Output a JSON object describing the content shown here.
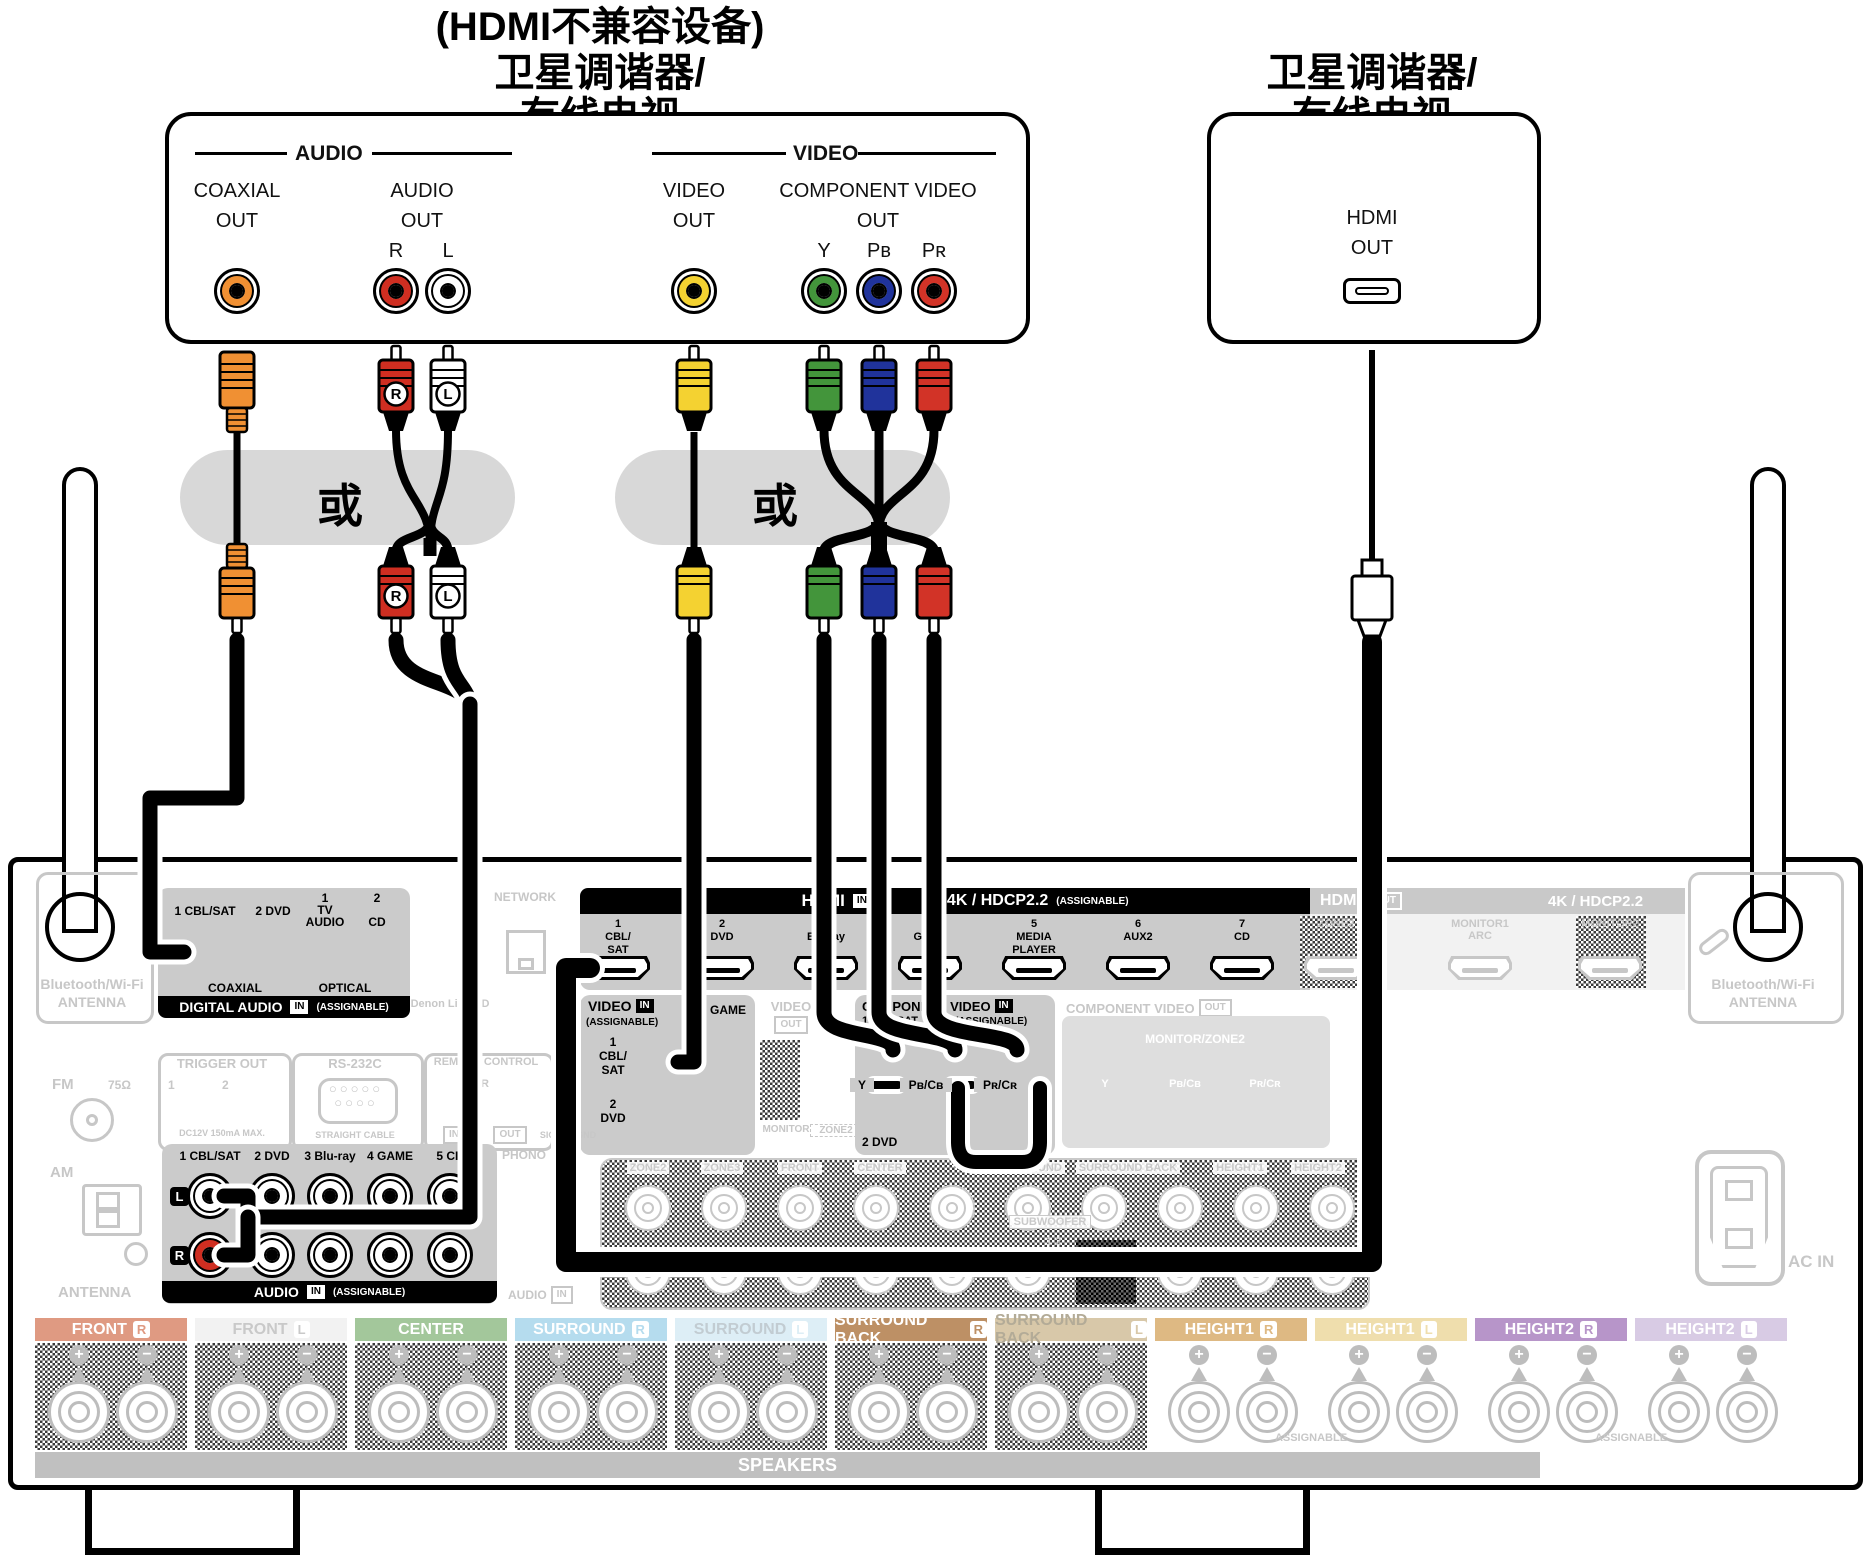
{
  "titles": {
    "left_note": "(HDMI不兼容设备)",
    "left_line1": "卫星调谐器/",
    "left_line2": "有线电视",
    "right_line1": "卫星调谐器/",
    "right_line2": "有线电视",
    "or_label": "或"
  },
  "device_left": {
    "audio_group": "AUDIO",
    "video_group": "VIDEO",
    "coaxial1": "COAXIAL",
    "coaxial2": "OUT",
    "audio1": "AUDIO",
    "audio2": "OUT",
    "r": "R",
    "l": "L",
    "video1": "VIDEO",
    "video2": "OUT",
    "comp1": "COMPONENT VIDEO",
    "comp2": "OUT",
    "y": "Y",
    "pb": "Pʙ",
    "pr": "Pʀ"
  },
  "device_right": {
    "hdmi1": "HDMI",
    "hdmi2": "OUT"
  },
  "plug_badges": {
    "r": "R",
    "l": "L"
  },
  "receiver": {
    "bt_line1": "Bluetooth/Wi-Fi",
    "bt_line2": "ANTENNA",
    "digital_audio": {
      "jack1": "1 CBL/SAT",
      "jack2": "2 DVD",
      "opt1n": "1",
      "opt1a": "TV",
      "opt1b": "AUDIO",
      "opt2n": "2",
      "opt2": "CD",
      "coaxial": "COAXIAL",
      "optical": "OPTICAL",
      "title": "DIGITAL AUDIO",
      "in": "IN",
      "assignable": "(ASSIGNABLE)"
    },
    "denon_link": "Denon Link HD",
    "network": "NETWORK",
    "hdmi_in": {
      "title": "HDMI",
      "in": "IN",
      "spec": "4K / HDCP2.2",
      "assignable": "(ASSIGNABLE)",
      "ports": [
        [
          "1",
          "CBL/",
          "SAT"
        ],
        [
          "2",
          "DVD"
        ],
        [
          "3",
          "Blu-ray"
        ],
        [
          "4",
          "GAME"
        ],
        [
          "5",
          "MEDIA",
          "PLAYER"
        ],
        [
          "6",
          "AUX2"
        ],
        [
          "7",
          "CD"
        ]
      ]
    },
    "hdmi_out": {
      "title": "HDMI",
      "out": "OUT",
      "spec": "4K / HDCP2.2",
      "ports": [
        [
          "ZONE2"
        ],
        [
          "MONITOR1",
          "ARC"
        ],
        [
          "MONITOR2"
        ]
      ]
    },
    "video_in": {
      "title": "VIDEO",
      "in": "IN",
      "assignable": "(ASSIGNABLE)",
      "j1a": "1",
      "j1b": "CBL/",
      "j1c": "SAT",
      "j2": "3 GAME",
      "j3a": "2",
      "j3b": "DVD"
    },
    "video_out": {
      "title": "VIDEO",
      "out": "OUT",
      "monitor": "MONITOR",
      "zone2": "ZONE2"
    },
    "component_in": {
      "title": "COMPONENT VIDEO",
      "in": "IN",
      "assignable": "(ASSIGNABLE)",
      "row1": "1 CBL/SAT",
      "y": "Y",
      "pbcb": "Pʙ/Cʙ",
      "prcr": "Pʀ/Cʀ",
      "row2": "2 DVD"
    },
    "component_out": {
      "title": "COMPONENT VIDEO",
      "out": "OUT",
      "monitor_zone2": "MONITOR/ZONE2",
      "y": "Y",
      "pbcb": "Pʙ/Cʙ",
      "prcr": "Pʀ/Cʀ"
    },
    "trigger": {
      "title": "TRIGGER OUT",
      "n1": "1",
      "n2": "2",
      "note": "DC12V 150mA MAX."
    },
    "rs232c": {
      "title": "RS-232C",
      "note": "STRAIGHT CABLE"
    },
    "remote": {
      "title": "REMOTE CONTROL",
      "ir": "IR",
      "in": "IN",
      "out": "OUT"
    },
    "signal_gnd": "SIGNAL GND",
    "fm": "FM",
    "ohm": "75Ω",
    "am": "AM",
    "antenna": "ANTENNA",
    "audio_in": {
      "cols": [
        "1 CBL/SAT",
        "2 DVD",
        "3 Blu-ray",
        "4 GAME",
        "5 CD"
      ],
      "l": "L",
      "r": "R",
      "title": "AUDIO",
      "in": "IN",
      "assignable": "(ASSIGNABLE)"
    },
    "phono": "PHONO",
    "audio_in_gray": {
      "title": "AUDIO",
      "in": "IN"
    },
    "preout": {
      "labels": [
        "ZONE2",
        "ZONE3",
        "FRONT",
        "CENTER",
        "SURROUND",
        "SURROUND BACK",
        "HEIGHT1",
        "HEIGHT2"
      ],
      "subwoofer": "SUBWOOFER",
      "sub_nums": "1 2"
    },
    "ac_in": "AC IN",
    "speakers_bar": "SPEAKERS",
    "assignable_h1": "ASSIGNABLE",
    "assignable_h2": "ASSIGNABLE",
    "speaker_groups": [
      {
        "name": "FRONT",
        "ch": "R",
        "bg": "#df9a82",
        "fg": "#ffffff",
        "dim": true
      },
      {
        "name": "FRONT",
        "ch": "L",
        "bg": "#f2f2f2",
        "fg": "#c9c9c9",
        "dim": true
      },
      {
        "name": "CENTER",
        "ch": "",
        "bg": "#a3c79b",
        "fg": "#ffffff",
        "dim": true
      },
      {
        "name": "SURROUND",
        "ch": "R",
        "bg": "#b5dcee",
        "fg": "#ffffff",
        "dim": true
      },
      {
        "name": "SURROUND",
        "ch": "L",
        "bg": "#ddeef6",
        "fg": "#c2ccd2",
        "dim": true
      },
      {
        "name": "SURROUND BACK",
        "ch": "R",
        "bg": "#bd9065",
        "fg": "#ffffff",
        "dim": true
      },
      {
        "name": "SURROUND BACK",
        "ch": "L",
        "bg": "#d8c8a9",
        "fg": "#b3ab97",
        "dim": true
      },
      {
        "name": "HEIGHT1",
        "ch": "R",
        "bg": "#deb983",
        "fg": "#ffffff",
        "dim": false
      },
      {
        "name": "HEIGHT1",
        "ch": "L",
        "bg": "#efdead",
        "fg": "#ffffff",
        "dim": false
      },
      {
        "name": "HEIGHT2",
        "ch": "R",
        "bg": "#b795c9",
        "fg": "#ffffff",
        "dim": false
      },
      {
        "name": "HEIGHT2",
        "ch": "L",
        "bg": "#d8cbe4",
        "fg": "#ffffff",
        "dim": false
      }
    ]
  },
  "colors": {
    "orange": "#f09033",
    "red": "#cf2e21",
    "white": "#ffffff",
    "yellow": "#f4d231",
    "green": "#43953b",
    "blue": "#20339b",
    "comp_red": "#d23327",
    "gray_dim": "#c7c7c7",
    "section_gray": "#cbcbcb",
    "pill_gray": "#d8d8d8"
  }
}
